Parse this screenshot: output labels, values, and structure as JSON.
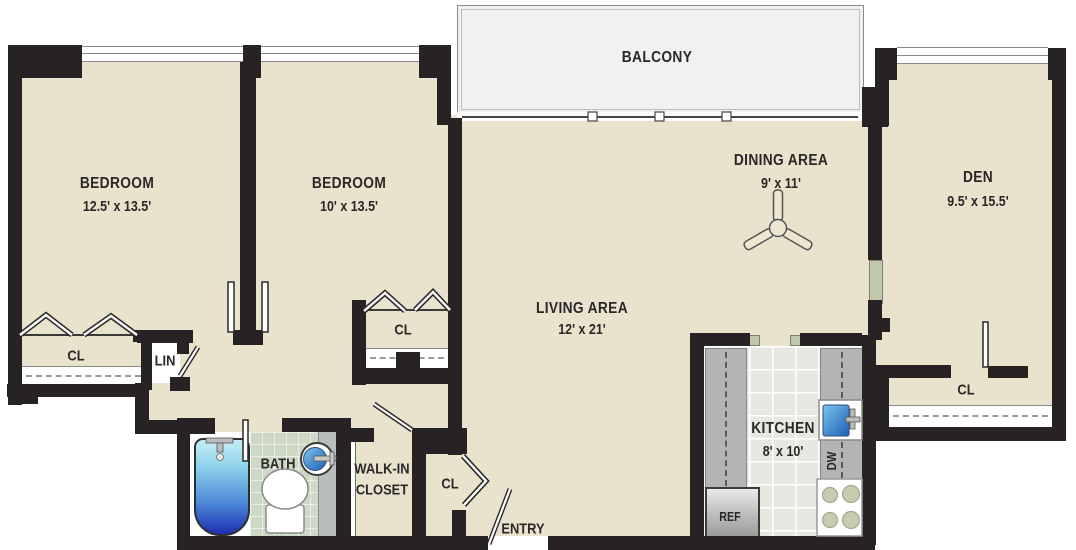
{
  "plan_title": "apartment-floor-plan",
  "rooms": {
    "balcony": {
      "name": "BALCONY"
    },
    "bedroom_left": {
      "name": "BEDROOM",
      "dims": "12.5' x 13.5'"
    },
    "bedroom_middle": {
      "name": "BEDROOM",
      "dims": "10' x 13.5'"
    },
    "living_area": {
      "name": "LIVING AREA",
      "dims": "12' x 21'"
    },
    "dining_area": {
      "name": "DINING AREA",
      "dims": "9' x 11'"
    },
    "den": {
      "name": "DEN",
      "dims": "9.5' x 15.5'"
    },
    "kitchen": {
      "name": "KITCHEN",
      "dims": "8' x 10'"
    },
    "bath": {
      "name": "BATH"
    },
    "walk_in_closet": {
      "line1": "WALK-IN",
      "line2": "CLOSET"
    },
    "entry": {
      "name": "ENTRY"
    }
  },
  "closets": {
    "bedroom_left_closet": "CL",
    "bedroom_middle_closet": "CL",
    "entry_closet": "CL",
    "den_closet": "CL",
    "linen_closet": "LIN"
  },
  "appliances": {
    "refrigerator": "REF",
    "dishwasher": "DW"
  },
  "fixtures": [
    "ceiling-fan",
    "bathtub",
    "toilet",
    "round-sink",
    "kitchen-sink",
    "stove",
    "refrigerator",
    "sliding-balcony-door",
    "bifold-closet-doors",
    "door-swings"
  ],
  "colors": {
    "wall": "#272223",
    "floor": "#e9e2cd",
    "balcony_floor": "#f1f1f1",
    "kitchen_floor": "#e8e8e2",
    "counter": "#b4b4b4",
    "bath_tile": "#cdd8c5",
    "tub_blue_top": "#c6eff6",
    "tub_blue_bottom": "#1e2fae",
    "sink_blue": "#2a6fc0",
    "burner_green": "#c6cbb0",
    "text": "#2b2728"
  }
}
